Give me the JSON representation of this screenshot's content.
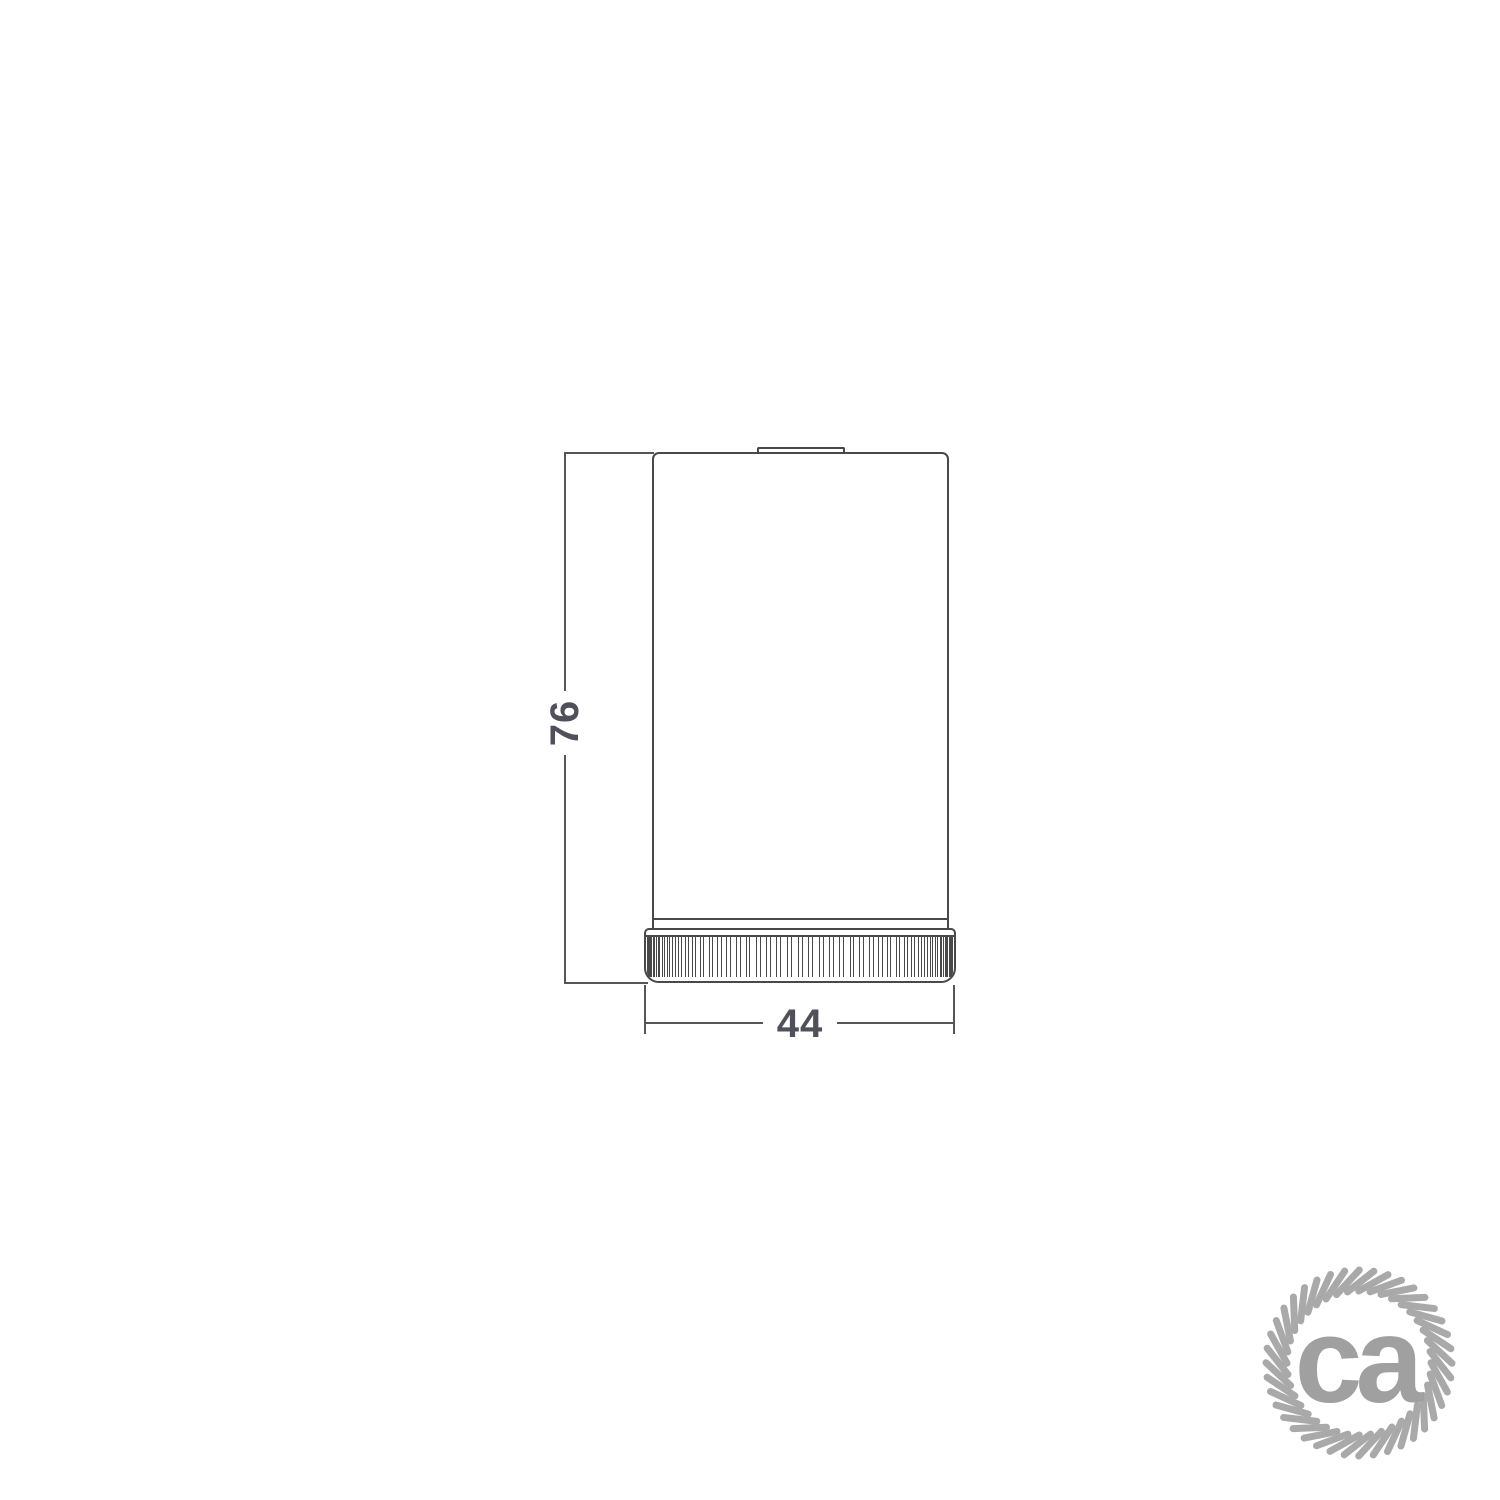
{
  "drawing": {
    "height_dimension_label": "76",
    "width_dimension_label": "44",
    "line_color": "#494949",
    "dim_line_color": "#55555a",
    "dim_text_color": "#50505a"
  },
  "knurl": {
    "groove_count": 45,
    "max_angle_deg": 88
  },
  "logo": {
    "text": "ca",
    "rope_icon": "rope-circle-icon",
    "rope_color": "#a9a9a9",
    "text_color": "#a0a0a0",
    "strand_count": 40
  }
}
